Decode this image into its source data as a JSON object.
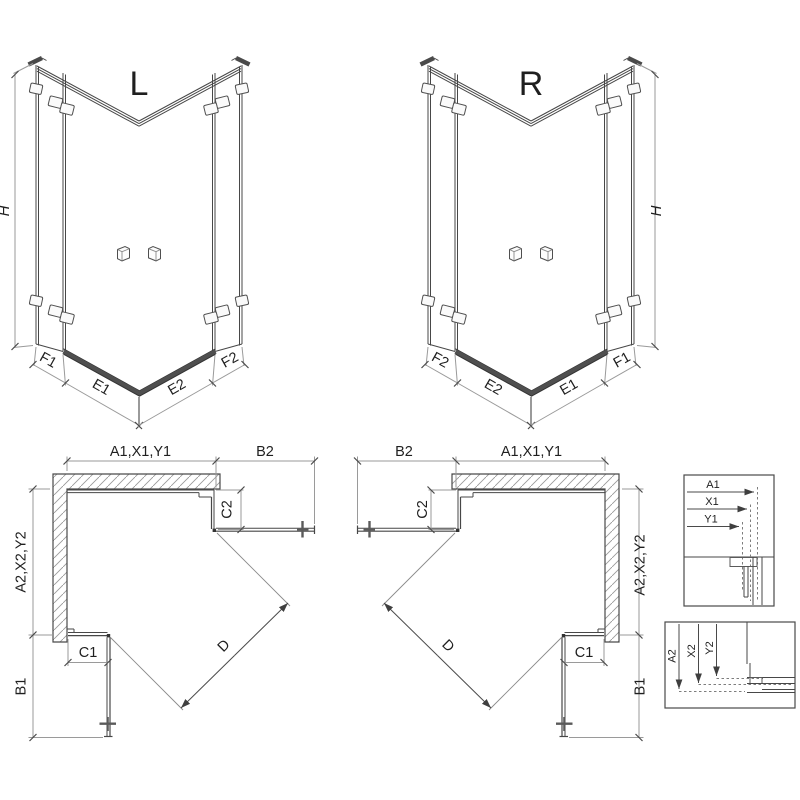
{
  "iso_left": {
    "variant": "L",
    "height": "H",
    "dim1": "F1",
    "dim2": "E1",
    "dim3": "E2",
    "dim4": "F2"
  },
  "iso_right": {
    "variant": "R",
    "height": "H",
    "dim1": "F2",
    "dim2": "E2",
    "dim3": "E1",
    "dim4": "F1"
  },
  "plan_left": {
    "top_width": "A1,X1,Y1",
    "door_top": "B2",
    "return_top": "C2",
    "side_width": "A2,X2,Y2",
    "return_bottom": "C1",
    "door_bottom": "B1",
    "diagonal": "D"
  },
  "plan_right": {
    "top_width": "A1,X1,Y1",
    "door_top": "B2",
    "return_top": "C2",
    "side_width": "A2,X2,Y2",
    "return_bottom": "C1",
    "door_bottom": "B1",
    "diagonal": "D"
  },
  "detail_horizontal": {
    "row1": "A1",
    "row2": "X1",
    "row3": "Y1"
  },
  "detail_vertical": {
    "col1": "A2",
    "col2": "X2",
    "col3": "Y2"
  },
  "colors": {
    "line": "#474747",
    "dim": "#9a9a9a",
    "text": "#1f1f1f",
    "threshold": "#4f4f4f",
    "hatch": "#9a9a9a",
    "background": "#ffffff"
  }
}
